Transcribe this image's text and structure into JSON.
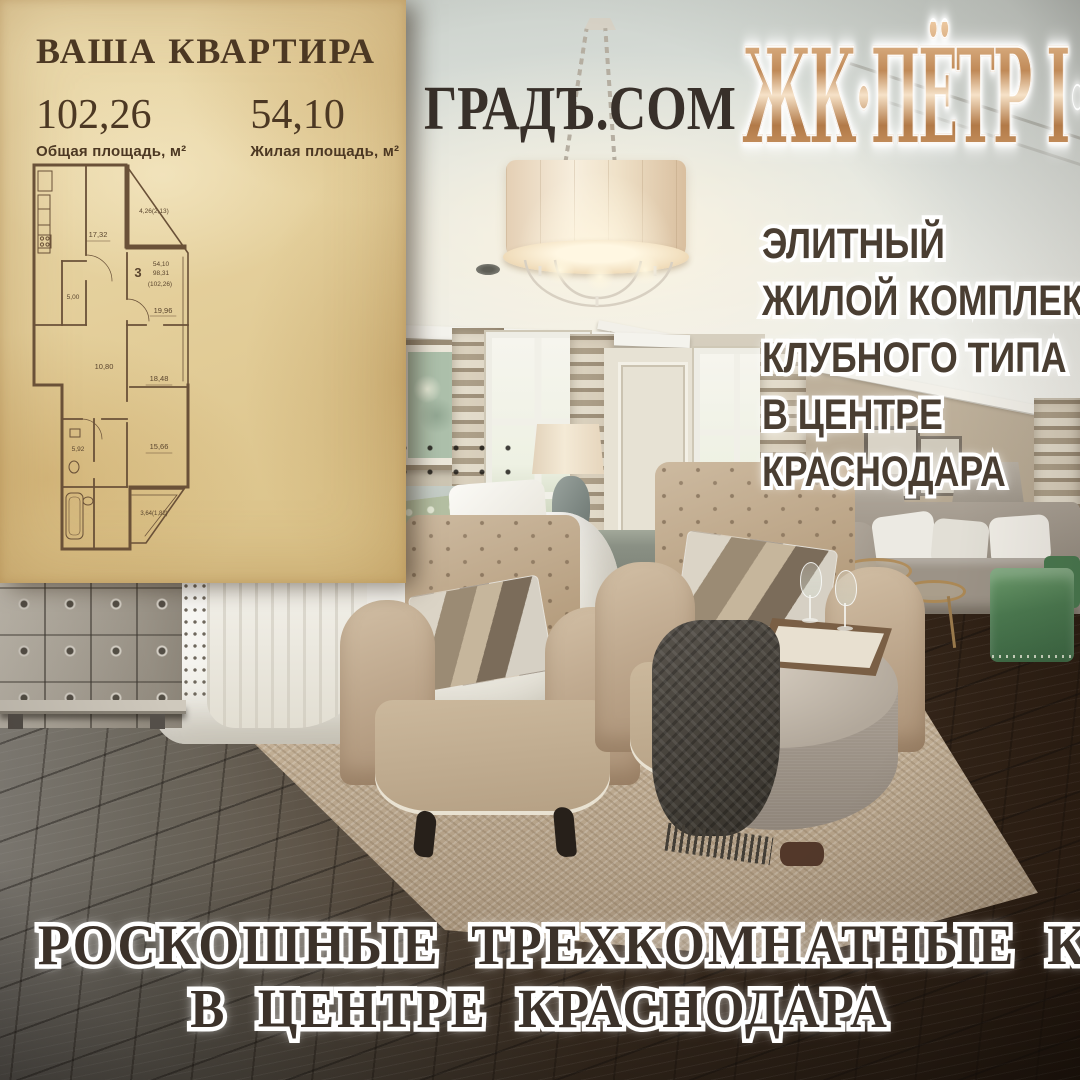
{
  "panel": {
    "title": "ВАША КВАРТИРА",
    "stats": [
      {
        "value": "102,26",
        "label": "Общая площадь, м²"
      },
      {
        "value": "54,10",
        "label": "Жилая площадь, м²"
      }
    ],
    "floorplan": {
      "rooms_count": "3",
      "living_area": "54,10",
      "area_no_balcony": "98,31",
      "total_area": "(102,26)",
      "room_areas": [
        "17,32",
        "4,26(2,13)",
        "19,96",
        "10,80",
        "5,00",
        "5,92",
        "18,48",
        "15,66",
        "3,64(1,82)"
      ]
    }
  },
  "watermark": {
    "text": "ГРАДЪ.COM"
  },
  "logo": {
    "text": "ЖК·ПЁТР I·"
  },
  "features": {
    "lines": [
      "ЭЛИТНЫЙ",
      "ЖИЛОЙ КОМПЛЕКС",
      "КЛУБНОГО ТИПА",
      "В ЦЕНТРЕ",
      "КРАСНОДАРА"
    ]
  },
  "headline": {
    "line1": "РОСКОШНЫЕ ТРЕХКОМНАТНЫЕ КВАРТИРЫ",
    "line2": "В ЦЕНТРЕ КРАСНОДАРА"
  },
  "colors": {
    "parchment": "#e4cf9b",
    "panel_text": "#4c3823",
    "headline_text": "#3c322a",
    "features_text": "#4a3e32",
    "watermark_text": "#38302a",
    "logo_copper": "#c08a58",
    "accent_green": "#4c7b51",
    "floor_dark": "#2b1d12"
  }
}
